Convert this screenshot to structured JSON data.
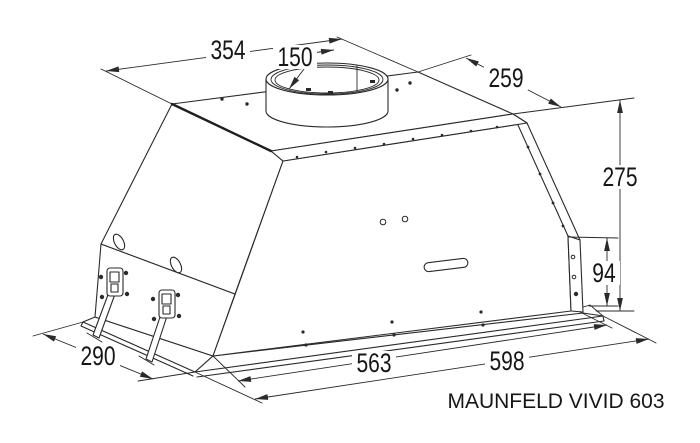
{
  "drawing": {
    "product_label": "MAUNFELD VIVID 603",
    "dimensions": {
      "top_width": "354",
      "duct_diameter": "150",
      "top_depth": "259",
      "total_height": "275",
      "lower_body_height": "94",
      "flange_depth": "290",
      "body_width": "563",
      "flange_width": "598"
    }
  }
}
